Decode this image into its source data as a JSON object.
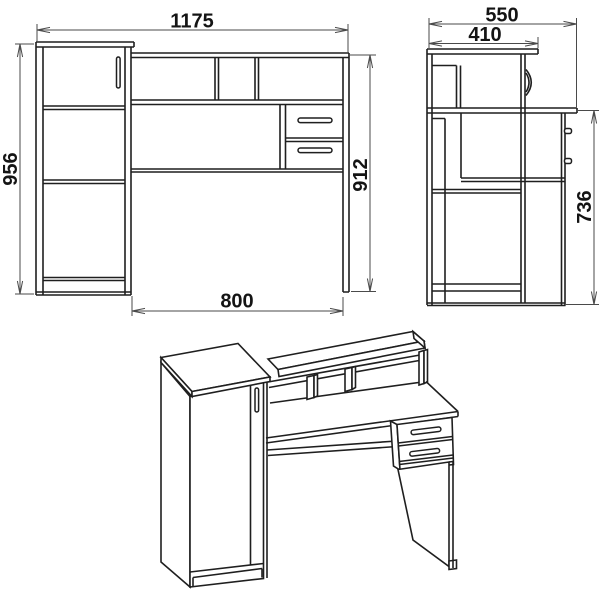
{
  "page": {
    "title_hint": "desk-assembly-blueprint",
    "background": "#ffffff",
    "line_color": "#1f1f1f",
    "dimension_line_color": "#4a4a4a",
    "text_color": "#141414"
  },
  "views": {
    "front": {
      "label": "front-view",
      "dimensions": {
        "overall_width": "1175",
        "cabinet_height": "956",
        "desk_height": "912",
        "kneehole_width": "800"
      }
    },
    "side": {
      "label": "side-view",
      "dimensions": {
        "overall_depth": "550",
        "top_shelf_depth": "410",
        "worktop_height": "736"
      }
    },
    "isometric": {
      "label": "isometric-view"
    }
  }
}
